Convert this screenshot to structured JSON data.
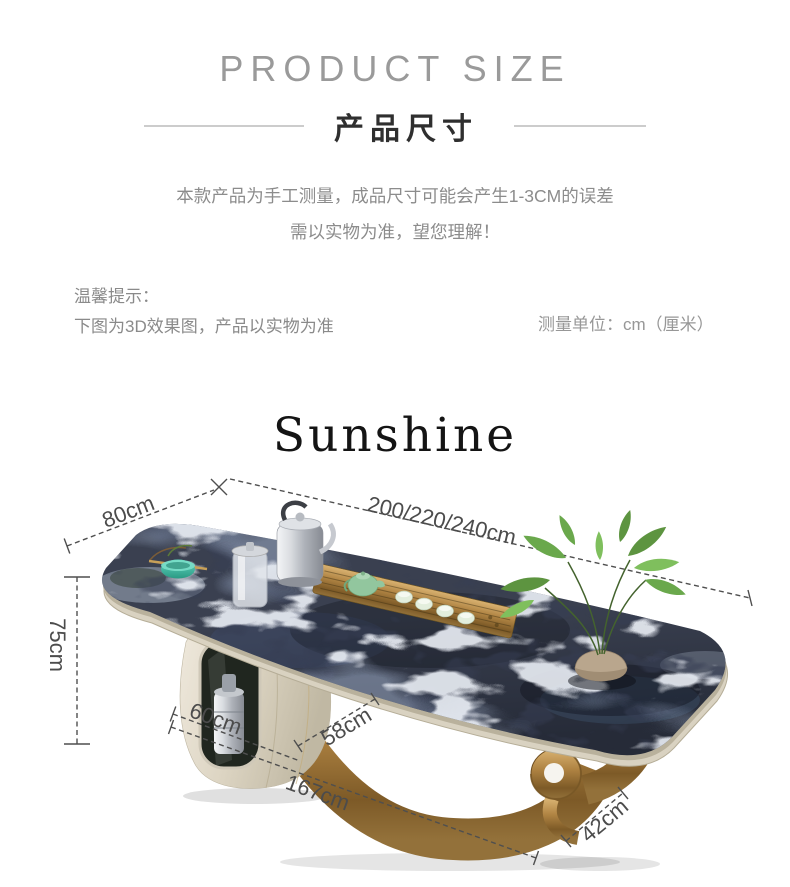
{
  "header": {
    "title_en": "PRODUCT SIZE",
    "title_cn": "产品尺寸",
    "note_line1": "本款产品为手工测量，成品尺寸可能会产生1-3CM的误差",
    "note_line2": "需以实物为准，望您理解！"
  },
  "tips": {
    "label": "温馨提示：",
    "line": "下图为3D效果图，产品以实物为准",
    "unit": "测量单位：cm（厘米）"
  },
  "watermark": "Sunshine",
  "dimensions": {
    "top_depth": "80cm",
    "top_length": "200/220/240cm",
    "height": "75cm",
    "cabinet_width": "60cm",
    "leg_span": "58cm",
    "base_length": "167cm",
    "base_depth": "42cm"
  },
  "colors": {
    "marble_dark": "#3a4050",
    "marble_vein": "#d7dde8",
    "gold": "#b08443",
    "cream_cabinet": "#ddd5c3",
    "teal_bowl": "#3fbba5",
    "plant_green": "#6aa84c",
    "label_gray": "#4c4c4c",
    "title_gray": "#9a9a9a"
  }
}
